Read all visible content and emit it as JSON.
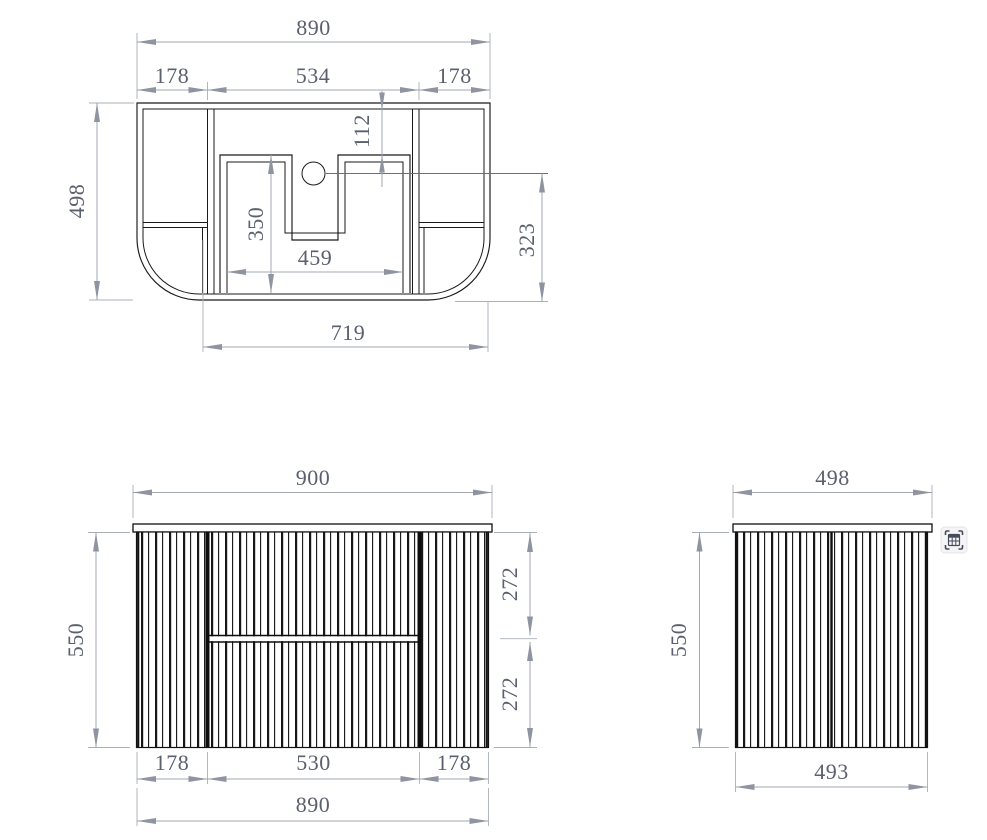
{
  "drawing": {
    "colors": {
      "draw_line": "#1a1a1a",
      "dim_line": "#a2a7b0",
      "dim_text": "#5b606e",
      "background": "#ffffff"
    },
    "top_view": {
      "overall_width": "890",
      "left_section": "178",
      "center_section": "534",
      "right_section": "178",
      "tap_setback": "112",
      "overall_depth": "498",
      "recess_depth": "350",
      "recess_width": "459",
      "basin_front_depth": "323",
      "base_width": "719"
    },
    "front_view": {
      "overall_width": "900",
      "height": "550",
      "upper_drawer_height": "272",
      "lower_drawer_height": "272",
      "left_door_width": "178",
      "drawer_width": "530",
      "right_door_width": "178",
      "carcass_width": "890"
    },
    "side_view": {
      "top_width": "498",
      "height": "550",
      "bottom_width": "493"
    },
    "overlay": {
      "icon": "table-capture-icon"
    }
  }
}
